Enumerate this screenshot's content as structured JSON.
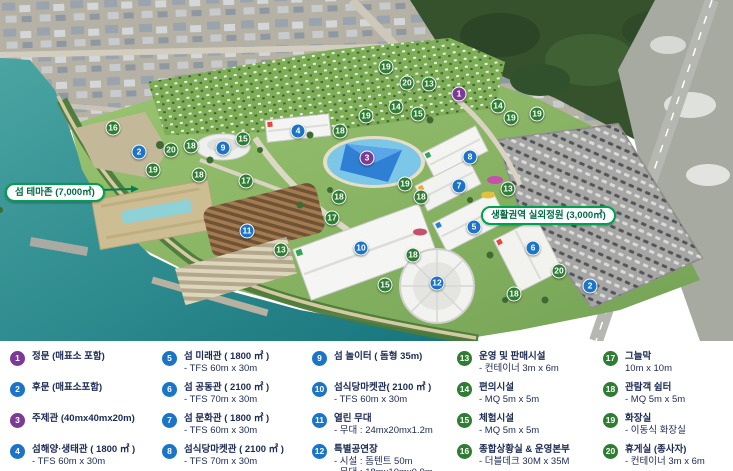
{
  "colors": {
    "purple": "#7b3a96",
    "blue": "#1b74c6",
    "green": "#2e7d33",
    "label_border": "#00a14e",
    "label_text": "#046a45",
    "legend_text": "#1c2b55",
    "sea": "#1f7f85",
    "park": "#8db968",
    "parking": "#a6a6a4"
  },
  "map": {
    "labels": [
      {
        "text": "섬 테마존 (7,000㎡)",
        "x": 5,
        "y": 183
      },
      {
        "text": "생활권역 실외정원 (3,000㎡)",
        "x": 481,
        "y": 206
      }
    ],
    "markers": [
      {
        "n": 1,
        "x": 459,
        "y": 94,
        "color": "purple"
      },
      {
        "n": 3,
        "x": 367,
        "y": 158,
        "color": "purple"
      },
      {
        "n": 2,
        "x": 139,
        "y": 152,
        "color": "blue"
      },
      {
        "n": 2,
        "x": 590,
        "y": 286,
        "color": "blue"
      },
      {
        "n": 4,
        "x": 298,
        "y": 131,
        "color": "blue"
      },
      {
        "n": 5,
        "x": 474,
        "y": 227,
        "color": "blue"
      },
      {
        "n": 6,
        "x": 533,
        "y": 248,
        "color": "blue"
      },
      {
        "n": 7,
        "x": 459,
        "y": 186,
        "color": "blue"
      },
      {
        "n": 8,
        "x": 470,
        "y": 157,
        "color": "blue"
      },
      {
        "n": 9,
        "x": 223,
        "y": 148,
        "color": "blue"
      },
      {
        "n": 10,
        "x": 361,
        "y": 248,
        "color": "blue"
      },
      {
        "n": 11,
        "x": 247,
        "y": 231,
        "color": "blue"
      },
      {
        "n": 12,
        "x": 437,
        "y": 283,
        "color": "blue"
      },
      {
        "n": 13,
        "x": 429,
        "y": 84,
        "color": "green"
      },
      {
        "n": 13,
        "x": 281,
        "y": 250,
        "color": "green"
      },
      {
        "n": 13,
        "x": 508,
        "y": 189,
        "color": "green"
      },
      {
        "n": 14,
        "x": 396,
        "y": 107,
        "color": "green"
      },
      {
        "n": 14,
        "x": 498,
        "y": 106,
        "color": "green"
      },
      {
        "n": 15,
        "x": 243,
        "y": 139,
        "color": "green"
      },
      {
        "n": 15,
        "x": 418,
        "y": 114,
        "color": "green"
      },
      {
        "n": 15,
        "x": 385,
        "y": 285,
        "color": "green"
      },
      {
        "n": 16,
        "x": 113,
        "y": 128,
        "color": "green"
      },
      {
        "n": 17,
        "x": 246,
        "y": 181,
        "color": "green"
      },
      {
        "n": 17,
        "x": 332,
        "y": 218,
        "color": "green"
      },
      {
        "n": 18,
        "x": 191,
        "y": 146,
        "color": "green"
      },
      {
        "n": 18,
        "x": 199,
        "y": 175,
        "color": "green"
      },
      {
        "n": 18,
        "x": 340,
        "y": 131,
        "color": "green"
      },
      {
        "n": 18,
        "x": 339,
        "y": 197,
        "color": "green"
      },
      {
        "n": 18,
        "x": 421,
        "y": 197,
        "color": "green"
      },
      {
        "n": 18,
        "x": 413,
        "y": 255,
        "color": "green"
      },
      {
        "n": 18,
        "x": 514,
        "y": 294,
        "color": "green"
      },
      {
        "n": 19,
        "x": 153,
        "y": 170,
        "color": "green"
      },
      {
        "n": 19,
        "x": 386,
        "y": 67,
        "color": "green"
      },
      {
        "n": 19,
        "x": 366,
        "y": 116,
        "color": "green"
      },
      {
        "n": 19,
        "x": 511,
        "y": 118,
        "color": "green"
      },
      {
        "n": 19,
        "x": 537,
        "y": 114,
        "color": "green"
      },
      {
        "n": 19,
        "x": 405,
        "y": 184,
        "color": "green"
      },
      {
        "n": 20,
        "x": 171,
        "y": 150,
        "color": "green"
      },
      {
        "n": 20,
        "x": 407,
        "y": 83,
        "color": "green"
      },
      {
        "n": 20,
        "x": 559,
        "y": 271,
        "color": "green"
      }
    ]
  },
  "legend": {
    "columns": [
      [
        {
          "n": 1,
          "color": "purple",
          "title": "정문 (매표소 포함)",
          "sub": []
        },
        {
          "n": 2,
          "color": "blue",
          "title": "후문 (매표소포함)",
          "sub": []
        },
        {
          "n": 3,
          "color": "purple",
          "title": "주제관 (40mx40mx20m)",
          "sub": []
        },
        {
          "n": 4,
          "color": "blue",
          "title": "섬해양·생태관 ( 1800 ㎡ )",
          "sub": [
            "- TFS 60m x 30m"
          ]
        }
      ],
      [
        {
          "n": 5,
          "color": "blue",
          "title": "섬 미래관 ( 1800 ㎡ )",
          "sub": [
            "- TFS 60m x 30m"
          ]
        },
        {
          "n": 6,
          "color": "blue",
          "title": "섬 공동관 ( 2100 ㎡ )",
          "sub": [
            "- TFS 70m x 30m"
          ]
        },
        {
          "n": 7,
          "color": "blue",
          "title": "섬 문화관 ( 1800 ㎡ )",
          "sub": [
            "- TFS 60m x 30m"
          ]
        },
        {
          "n": 8,
          "color": "blue",
          "title": "섬식당마켓관 ( 2100 ㎡ )",
          "sub": [
            "- TFS 70m x 30m"
          ]
        }
      ],
      [
        {
          "n": 9,
          "color": "blue",
          "title": "섬 놀이터 ( 돔형 35m)",
          "sub": []
        },
        {
          "n": 10,
          "color": "blue",
          "title": "섬식당마켓관( 2100 ㎡ )",
          "sub": [
            "- TFS 60m x 30m"
          ]
        },
        {
          "n": 11,
          "color": "blue",
          "title": "열린 무대",
          "sub": [
            "- 무대 : 24mx20mx1.2m"
          ]
        },
        {
          "n": 12,
          "color": "blue",
          "title": "특별공연장",
          "sub": [
            "- 시설 : 돔텐트 50m",
            "- 무대 : 18mx10mx0.9m"
          ]
        }
      ],
      [
        {
          "n": 13,
          "color": "green",
          "title": "운영 및 판매시설",
          "sub": [
            "- 컨테이너 3m x 6m"
          ]
        },
        {
          "n": 14,
          "color": "green",
          "title": "편의시설",
          "sub": [
            "- MQ 5m x 5m"
          ]
        },
        {
          "n": 15,
          "color": "green",
          "title": "체험시설",
          "sub": [
            "- MQ 5m x 5m"
          ]
        },
        {
          "n": 16,
          "color": "green",
          "title": "종합상황실 & 운영본부",
          "sub": [
            "- 더블데크 30M x 35M"
          ]
        }
      ],
      [
        {
          "n": 17,
          "color": "green",
          "title": "그늘막",
          "sub": [
            "10m x 10m"
          ]
        },
        {
          "n": 18,
          "color": "green",
          "title": "관람객 쉼터",
          "sub": [
            "- MQ 5m x 5m"
          ]
        },
        {
          "n": 19,
          "color": "green",
          "title": "화장실",
          "sub": [
            "- 이동식 화장실"
          ]
        },
        {
          "n": 20,
          "color": "green",
          "title": "휴게실 (종사자)",
          "sub": [
            "- 컨테이너 3m x 6m"
          ]
        }
      ]
    ]
  }
}
